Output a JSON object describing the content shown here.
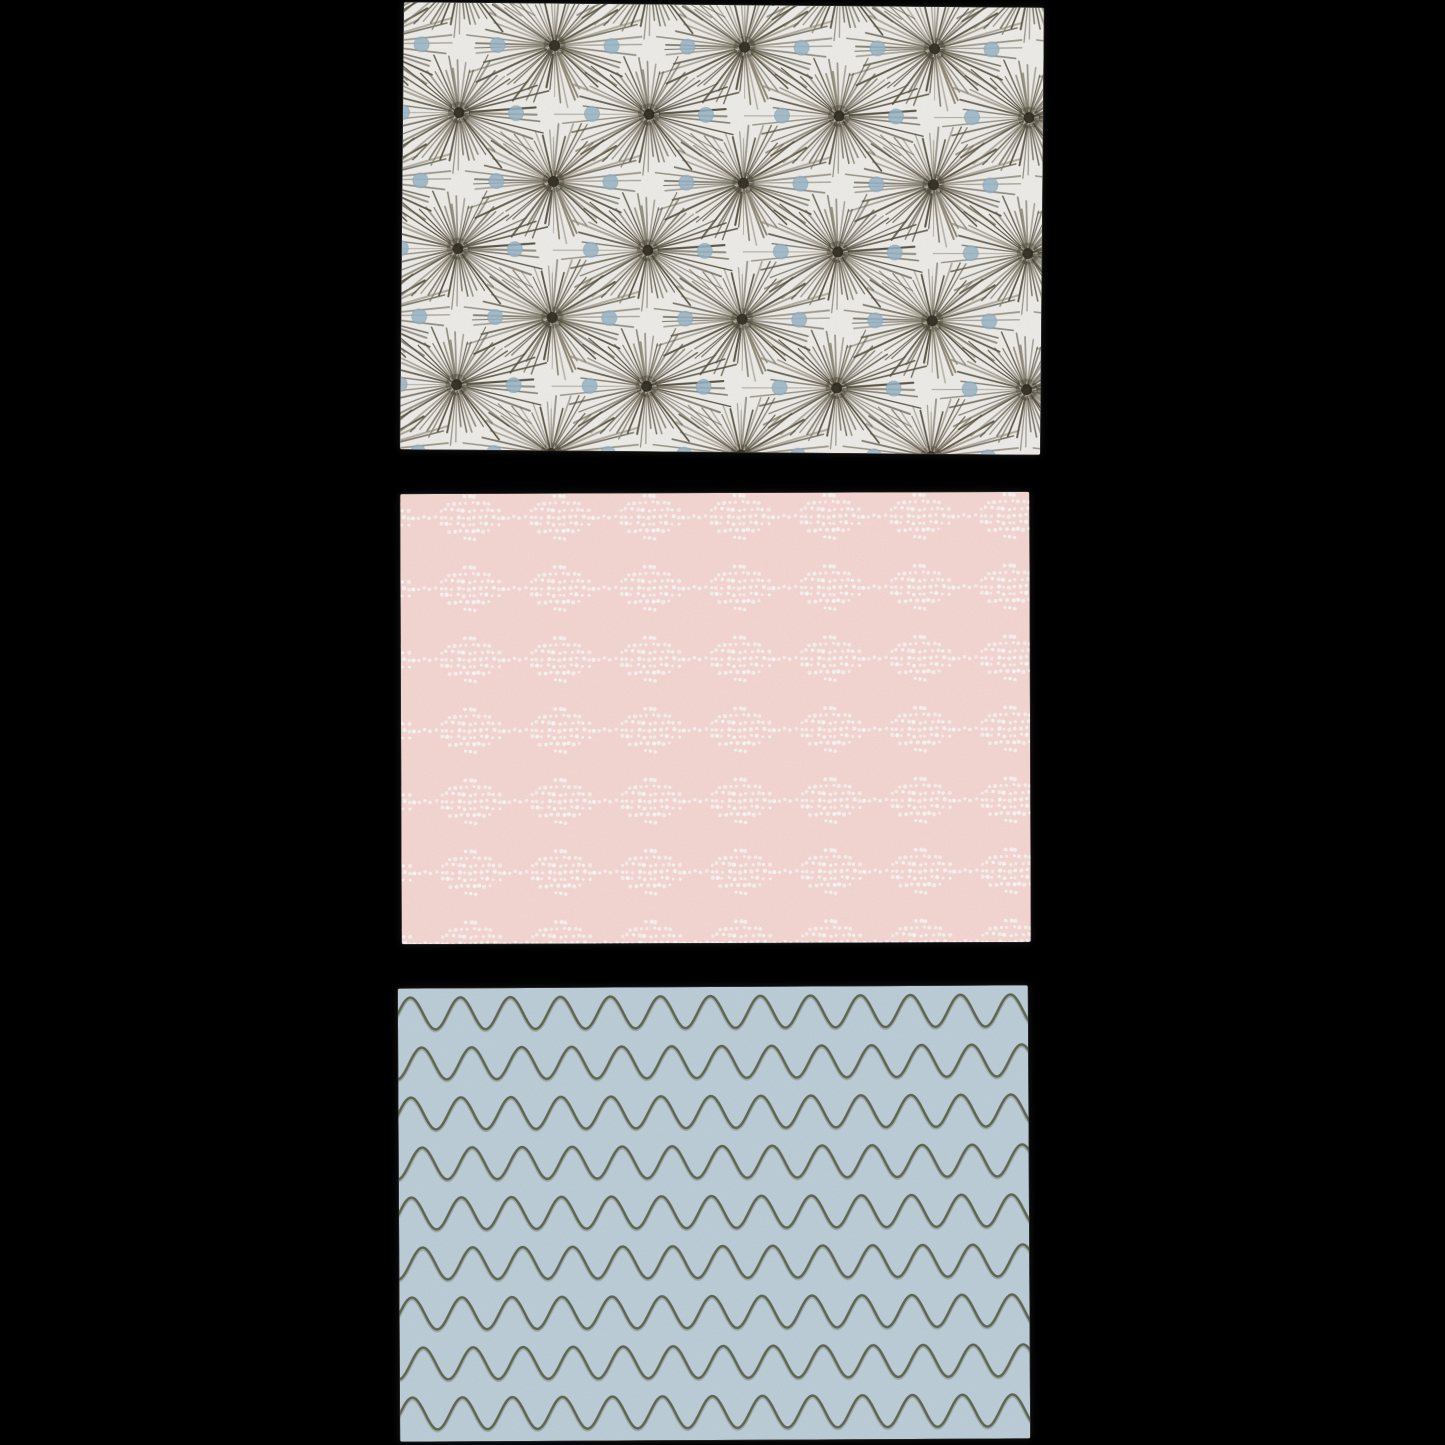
{
  "scene": {
    "background_color": "#000000",
    "description": "Three hand-patterned paper note cards stacked vertically on a black background",
    "card_count": "3"
  },
  "cards": [
    {
      "name": "starburst card",
      "description": "Off-white card covered with radiating dark olive ink starbursts and pale blue watercolor dots",
      "background": "#f4f2ee",
      "geometry": {
        "left": 402,
        "top": 5,
        "width": 640,
        "height": 447,
        "rotate_deg": 0.5
      },
      "pattern": {
        "type": "starburst",
        "ray_color": "#57513f",
        "ray_color_light": "#8a8371",
        "center_color": "#2d2a1d",
        "dot_color": "#9cb9cc",
        "dot_edge_color": "#84a7bd",
        "rays_per_burst": 56,
        "tile_width": 190,
        "tile_height": 136,
        "burst_radius_x": 92,
        "burst_radius_y": 60,
        "dot_radius": 7.5
      }
    },
    {
      "name": "dotted diamonds card",
      "description": "Blush pink card with horizontal rows of white dotted diamond clusters joined by dotted lines",
      "background": "#fadcd7",
      "geometry": {
        "left": 401,
        "top": 493,
        "width": 629,
        "height": 450,
        "rotate_deg": -0.2
      },
      "pattern": {
        "type": "dotted_diamonds",
        "dot_color": "#ffffff",
        "row_spacing": 71,
        "diamond_spacing": 90,
        "dot_spacing": 5.8,
        "dot_row_counts": [
          3,
          8,
          11,
          13,
          11,
          8,
          3
        ],
        "dot_radius": 1.7
      }
    },
    {
      "name": "waves card",
      "description": "Powder blue card with horizontal rows of hand-drawn olive-grey wavy lines",
      "background": "#c2d3de",
      "geometry": {
        "left": 399,
        "top": 987,
        "width": 630,
        "height": 453,
        "rotate_deg": -0.3
      },
      "pattern": {
        "type": "waves",
        "line_color": "#5e6650",
        "line_color_soft": "#7e8572",
        "row_spacing": 50,
        "wavelength": 50,
        "amplitude": 16,
        "line_width": 2.4
      }
    }
  ]
}
